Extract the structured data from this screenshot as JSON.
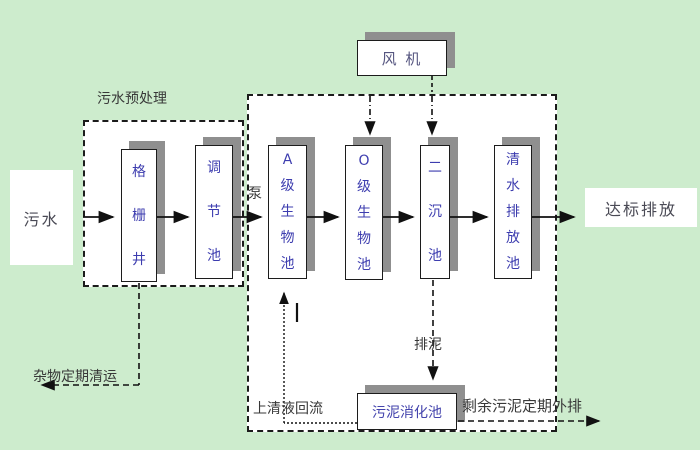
{
  "colors": {
    "background": "#cdeccd",
    "box_fill": "#ffffff",
    "box_shadow": "#8f8f8f",
    "tank_text": "#3d3daf",
    "annotation_text": "#383838",
    "line": "#1c1c1c"
  },
  "boxes": {
    "influent": "污水",
    "fan": "风 机",
    "effluent": "达标排放",
    "sludge_digester": "污泥消化池"
  },
  "tanks": [
    {
      "name": "grid-well",
      "label": "格栅井"
    },
    {
      "name": "regulating-tank",
      "label": "调节池"
    },
    {
      "name": "a-stage-bio-tank",
      "label": "A级生物池"
    },
    {
      "name": "o-stage-bio-tank",
      "label": "O级生物池"
    },
    {
      "name": "secondary-clarifier",
      "label": "二沉池"
    },
    {
      "name": "clear-water-discharge-tank",
      "label": "清水排放池"
    }
  ],
  "annotations": {
    "pretreatment": "污水预处理",
    "pump": "泵",
    "sludge_discharge": "排泥",
    "debris_removal": "杂物定期清运",
    "supernatant_return": "上清液回流",
    "surplus_sludge_out": "剩余污泥定期外排"
  }
}
